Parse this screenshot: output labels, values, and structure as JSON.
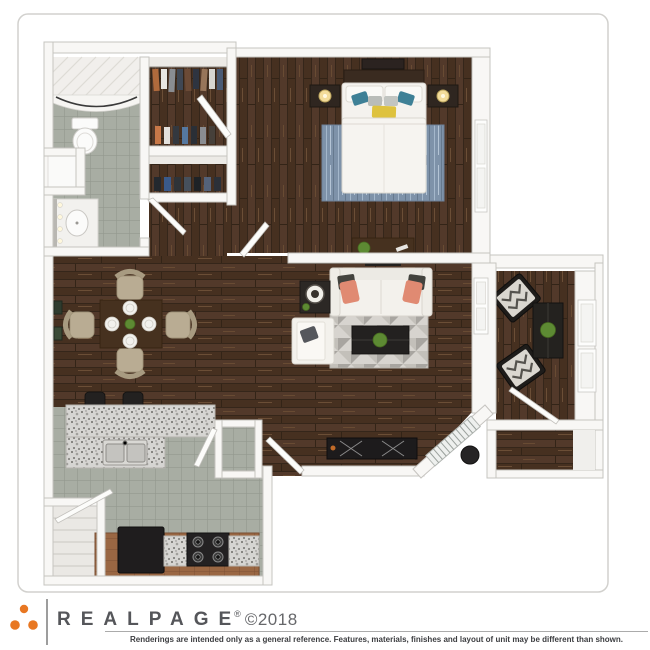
{
  "branding": {
    "side_copyright": "© 2019 LeaseStar LLC. All rights reserved.",
    "wordmark": "REALPAGE",
    "registered_mark": "®",
    "copyright_year": "©2018",
    "logo_dots_color": "#e87722",
    "disclaimer": "Renderings are intended only as a general reference. Features, materials, finishes and layout of unit may be different than shown."
  },
  "floorplan": {
    "type": "3d-top-down-apartment-rendering",
    "rooms": [
      "bathroom",
      "walk-in-closet",
      "linen-closet",
      "bedroom",
      "hallway",
      "dining-area",
      "living-room",
      "kitchen",
      "pantry",
      "utility-closet",
      "patio",
      "outdoor-storage"
    ],
    "furniture": [
      "shower",
      "toilet",
      "vanity-sink",
      "hanging-clothes",
      "queen-bed",
      "nightstands-with-lamps",
      "bedroom-rug",
      "dresser-with-plant",
      "dining-table-four-chairs",
      "breakfast-bar-with-stools",
      "double-sink",
      "refrigerator",
      "stove",
      "pantry-shelves",
      "sofa-with-pillows",
      "chaise-chair",
      "geometric-rug",
      "coffee-table",
      "media-console",
      "side-table-lamp",
      "patio-chairs-chevron-cushions",
      "patio-table",
      "grill"
    ],
    "colors": {
      "wood_floor": "#4c3525",
      "tile_floor": "#a6aba1",
      "walls": "#f8f7f5",
      "granite_counter": "#d6d5d2",
      "lower_counter": "#9a6743",
      "bedroom_rug": "#7e92a9",
      "living_rug": "#d7d4cf",
      "pillow_coral": "#e08a72",
      "pillow_teal": "#3e8096",
      "pillow_yellow": "#dec23e"
    }
  }
}
